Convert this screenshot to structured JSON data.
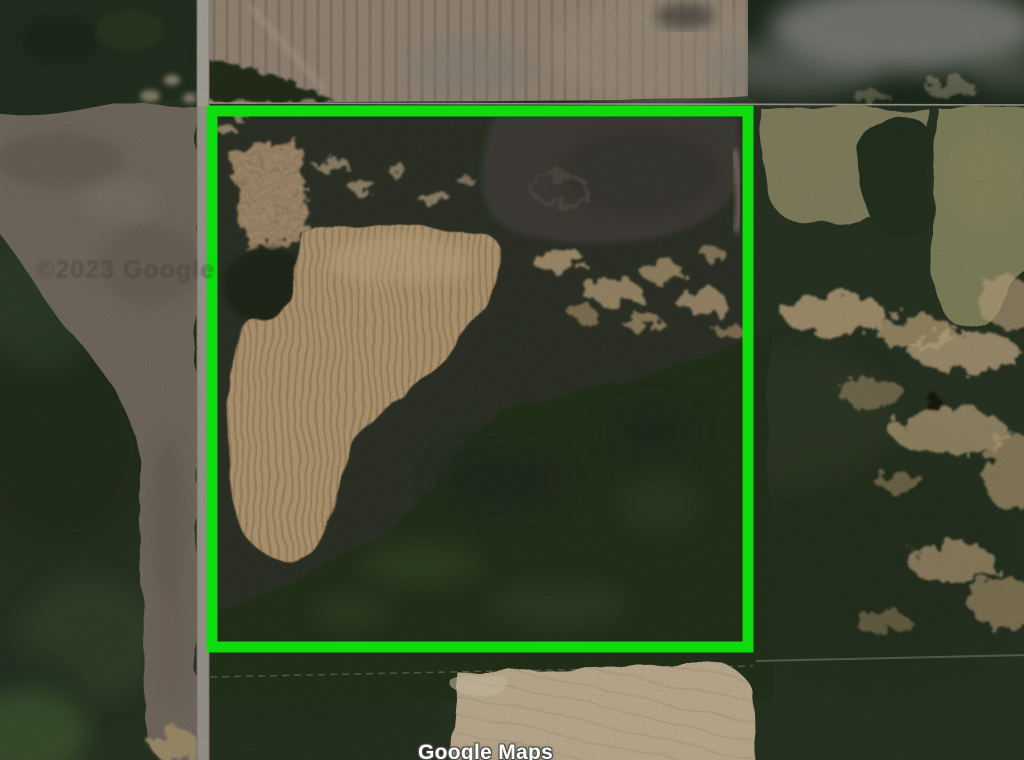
{
  "map": {
    "view_type": "satellite",
    "provider_label": "Google Maps",
    "attribution_watermark": "©2023 Google",
    "annotation": {
      "shape": "rectangle-outline",
      "color": "#0edc0e",
      "stroke_width_px": 11,
      "description": "bright green boundary outline highlighting a square rural land parcel"
    },
    "palette": {
      "forest_dark_green": "#2b3826",
      "bare_field_gray": "#7e7468",
      "parcel_cropland_tan": "#c2a67e",
      "north_farmland_tan": "#a29280",
      "meadow_olive": "#8e8a67",
      "south_field_cream": "#cfbd9e",
      "road_gray": "#aaa69c",
      "pond_dark": "#45423c",
      "smoke_gray": "#96968f"
    }
  }
}
